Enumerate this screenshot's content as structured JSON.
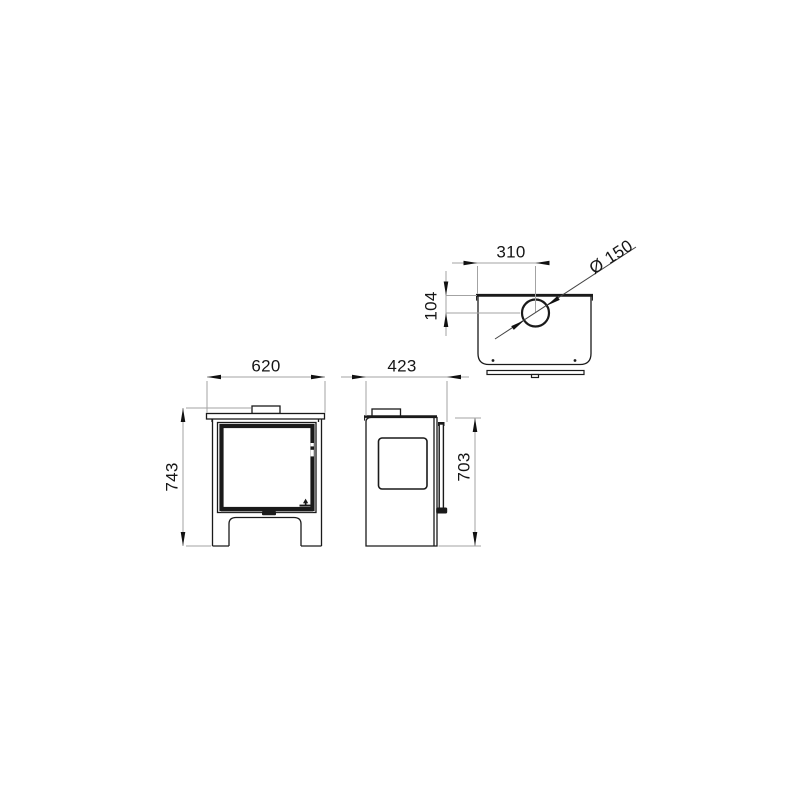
{
  "drawing": {
    "type": "technical-dimension-drawing",
    "subject": "wood-burning stove, three orthographic views",
    "units_implied": "mm",
    "colors": {
      "object_line": "#1a1a1a",
      "dimension_line": "#a3a3a3",
      "arrowhead": "#111111",
      "text": "#161616",
      "background": "#ffffff"
    },
    "views": {
      "front": {
        "name": "front view",
        "width_label": "620",
        "height_label": "743"
      },
      "side": {
        "name": "side view",
        "depth_label": "423",
        "body_height_label": "703"
      },
      "top": {
        "name": "top view",
        "flue_offset_from_side_label": "310",
        "flue_offset_from_back_label": "104",
        "flue_diameter_label": "Ø 150"
      }
    }
  }
}
